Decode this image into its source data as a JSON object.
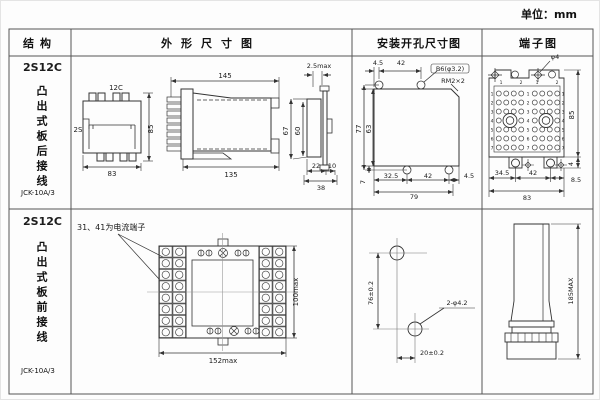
{
  "unit_label": "单位：mm",
  "headers": {
    "structure": "结构",
    "outline": "外形尺寸图",
    "mounting": "安装开孔尺寸图",
    "terminal": "端子图"
  },
  "rows": [
    {
      "model": "2S12C",
      "mount_style": "凸出式板后接线",
      "code": "JCK-10A/3",
      "outline": {
        "front": {
          "top": "12C",
          "left": "2S",
          "height": "85",
          "width": "83"
        },
        "side": {
          "top": "145",
          "bottom": "135"
        },
        "profile": {
          "thickness": "2.5max",
          "outer_h": "67",
          "inner_h": "60",
          "d1": "22",
          "d2": "10",
          "total": "38"
        }
      },
      "mounting": {
        "top_d1": "4.5",
        "top_d2": "42",
        "hole": "B6(φ3.2)",
        "corner": "RM2×2",
        "left_h": "77",
        "inner_h": "63",
        "bottom_offset": "7",
        "bottom_d1": "32.5",
        "bottom_d2": "42",
        "bottom_d3": "4.5",
        "bottom_total": "79"
      },
      "terminal": {
        "hole": "φ4",
        "height": "85",
        "offset": "4",
        "d1": "34.5",
        "d2": "42",
        "d3": "8.5",
        "total": "83",
        "row_nums": [
          "1",
          "2",
          "3",
          "4",
          "5",
          "6",
          "7"
        ],
        "col_nums": [
          "1",
          "2",
          "1",
          "2"
        ]
      }
    },
    {
      "model": "2S12C",
      "mount_style": "凸出式板前接线",
      "code": "JCK-10A/3",
      "outline": {
        "note": "31、41为电流端子",
        "width": "152max",
        "height": "100max"
      },
      "mounting": {
        "v": "76±0.2",
        "hole": "2-φ4.2",
        "h": "20±0.2"
      },
      "terminal": {
        "height": "185MAX"
      }
    }
  ]
}
